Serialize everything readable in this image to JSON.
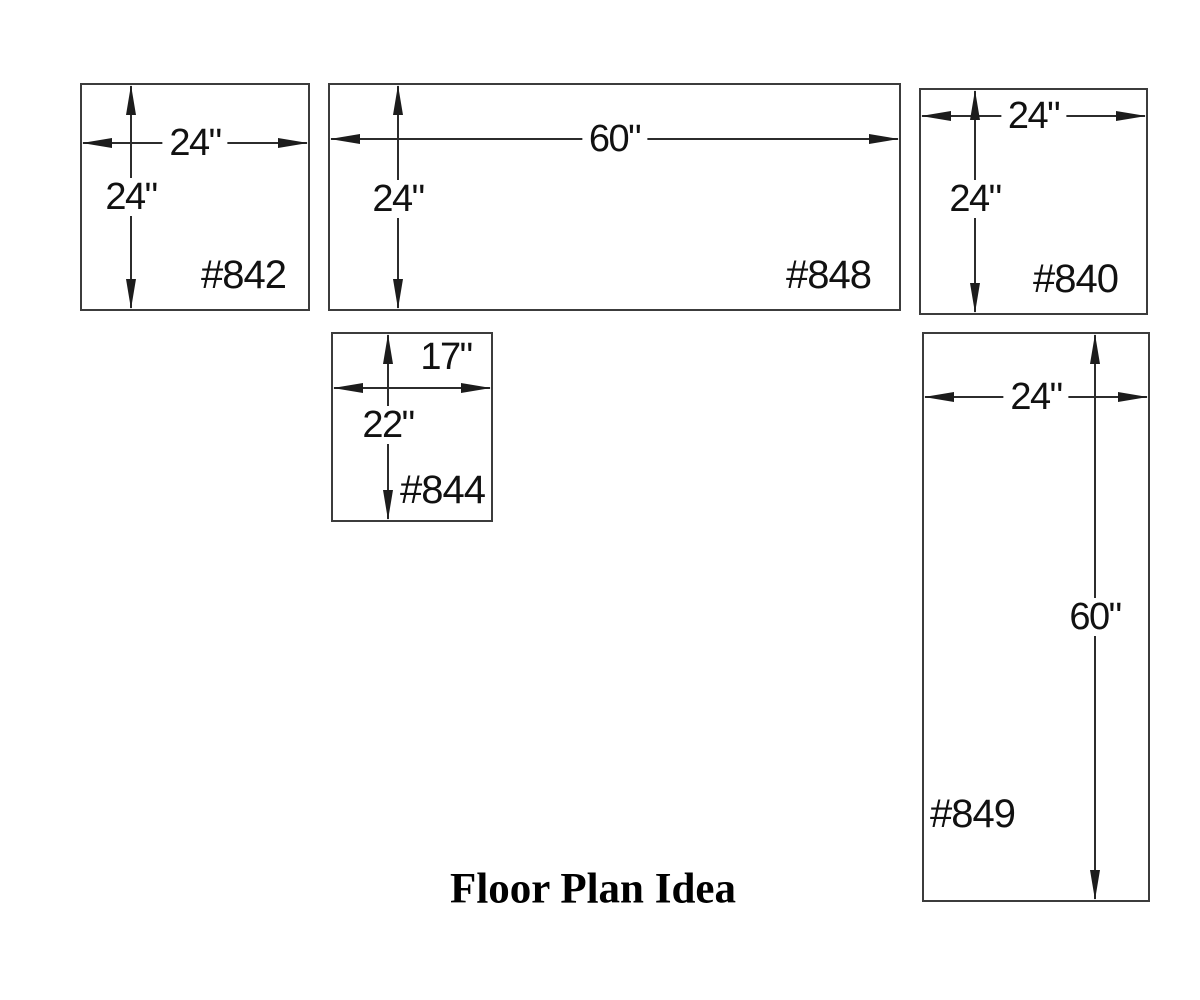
{
  "title": "Floor Plan Idea",
  "colors": {
    "background": "#ffffff",
    "line": "#2c2c2c",
    "text": "#111111"
  },
  "units": [
    {
      "id": "#842",
      "width_label": "24\"",
      "height_label": "24\""
    },
    {
      "id": "#848",
      "width_label": "60\"",
      "height_label": "24\""
    },
    {
      "id": "#840",
      "width_label": "24\"",
      "height_label": "24\""
    },
    {
      "id": "#844",
      "width_label": "17\"",
      "height_label": "22\""
    },
    {
      "id": "#849",
      "width_label": "24\"",
      "height_label": "60\""
    }
  ]
}
